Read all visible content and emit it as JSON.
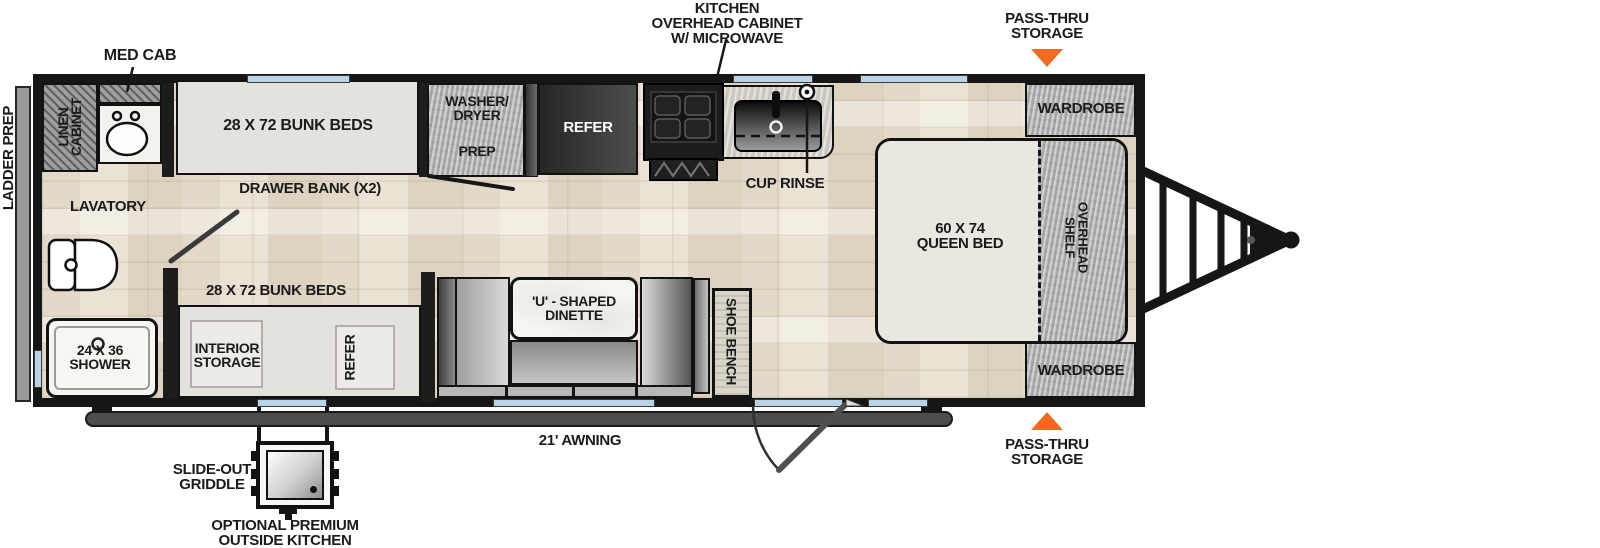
{
  "exterior": {
    "ladder_prep": "LADDER PREP",
    "med_cab": "MED CAB",
    "kitchen_overhead": {
      "lines": [
        "KITCHEN",
        "OVERHEAD CABINET",
        "W/ MICROWAVE"
      ]
    },
    "pass_thru_top": {
      "lines": [
        "PASS-THRU",
        "STORAGE"
      ]
    },
    "pass_thru_bottom": {
      "lines": [
        "PASS-THRU",
        "STORAGE"
      ]
    },
    "awning": "21' AWNING",
    "slide_out_griddle": {
      "lines": [
        "SLIDE-OUT",
        "GRIDDLE"
      ]
    },
    "outside_kitchen": {
      "lines": [
        "OPTIONAL PREMIUM",
        "OUTSIDE KITCHEN"
      ]
    }
  },
  "interior": {
    "linen_cabinet": {
      "lines": [
        "LINEN",
        "CABINET"
      ]
    },
    "lavatory": "LAVATORY",
    "shower": {
      "lines": [
        "24 X 36",
        "SHOWER"
      ]
    },
    "bunk_top": "28 X 72 BUNK BEDS",
    "drawer_bank": "DRAWER BANK (X2)",
    "washer_dryer": {
      "lines": [
        "WASHER/",
        "DRYER",
        "PREP"
      ]
    },
    "refer_top": "REFER",
    "cup_rinse": "CUP RINSE",
    "wardrobe_top": "WARDROBE",
    "queen_bed": {
      "lines": [
        "60 X 74",
        "QUEEN BED"
      ]
    },
    "overhead_shelf": {
      "lines": [
        "OVERHEAD",
        "SHELF"
      ]
    },
    "wardrobe_bottom": "WARDROBE",
    "shoe_bench": "SHOE BENCH",
    "dinette": {
      "lines": [
        "'U' - SHAPED",
        "DINETTE"
      ]
    },
    "bunk_bottom": "28 X 72 BUNK BEDS",
    "interior_storage": {
      "lines": [
        "INTERIOR",
        "STORAGE"
      ]
    },
    "refer_bottom": "REFER"
  },
  "colors": {
    "accent_orange": "#F26A21",
    "wall_black": "#161616",
    "window_blue": "#B9D4E6",
    "floor_wood": "#E5DDCD",
    "cabinet_gray": "#B4B4B4",
    "awning_gray": "#4D4D4D"
  }
}
